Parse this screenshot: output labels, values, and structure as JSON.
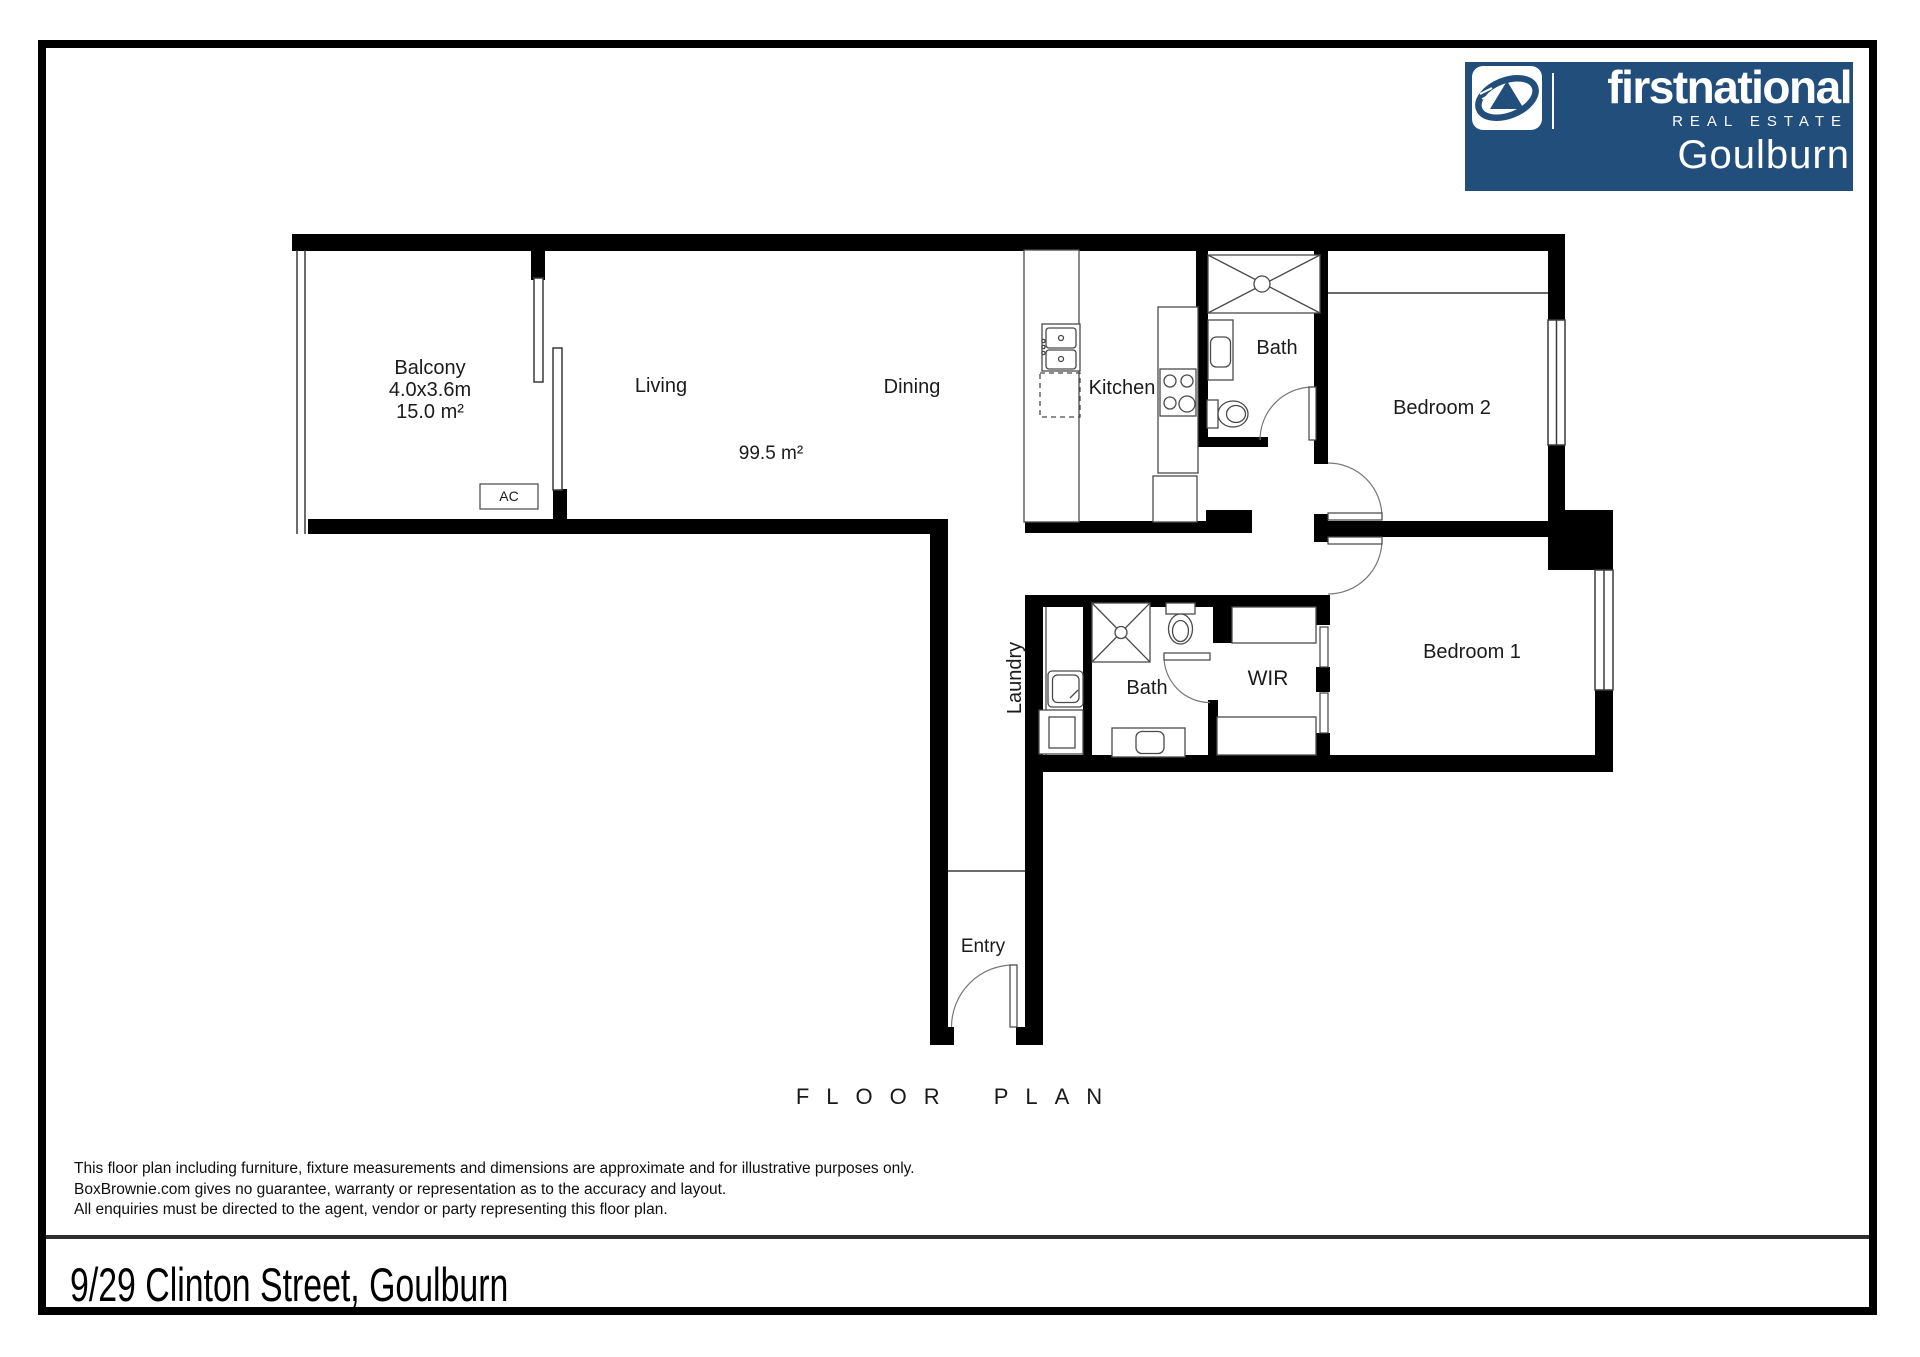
{
  "logo": {
    "brand": "firstnational",
    "tagline": "REAL ESTATE",
    "office": "Goulburn",
    "brand_color": "#224e7c"
  },
  "plan": {
    "balcony": {
      "name": "Balcony",
      "dimensions": "4.0x3.6m",
      "area": "15.0 m²"
    },
    "living": {
      "name": "Living"
    },
    "dining": {
      "name": "Dining"
    },
    "living_dining_area": "99.5 m²",
    "kitchen": {
      "name": "Kitchen"
    },
    "bath_top": {
      "name": "Bath"
    },
    "bath_lower": {
      "name": "Bath"
    },
    "bedroom2": {
      "name": "Bedroom 2"
    },
    "bedroom1": {
      "name": "Bedroom 1"
    },
    "wir": {
      "name": "WIR"
    },
    "laundry": {
      "name": "Laundry"
    },
    "entry": {
      "name": "Entry"
    },
    "ac_unit": {
      "label": "AC"
    }
  },
  "title": "FLOOR PLAN",
  "disclaimer": [
    "This floor plan including furniture, fixture measurements and dimensions are approximate and for illustrative purposes only.",
    "BoxBrownie.com gives no guarantee, warranty or representation as to the accuracy and layout.",
    "All enquiries must be directed to the agent, vendor or party representing this floor plan."
  ],
  "address": "9/29 Clinton Street, Goulburn"
}
